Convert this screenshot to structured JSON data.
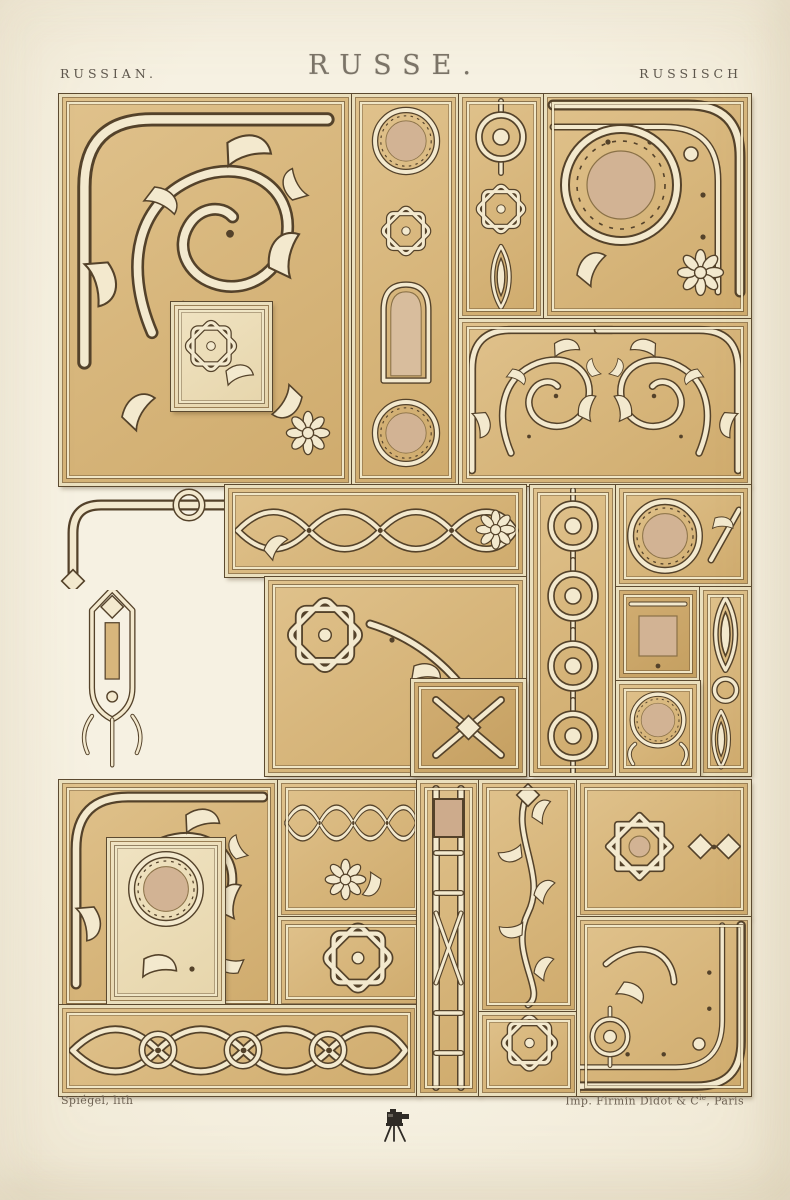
{
  "header": {
    "left_title": "RUSSIAN.",
    "center_title": "RUSSE.",
    "right_title": "RUSSISCH"
  },
  "footer": {
    "lithographer": "Spiégel, lith",
    "printer_prefix": "Imp. Firmin Didot & C",
    "printer_sup": "ie",
    "printer_suffix": ", Paris"
  },
  "icons": {
    "collection_mark": "camera-on-tripod-icon"
  },
  "palette": {
    "paper": "#f5f0e1",
    "panel_tan": "#d8b77e",
    "panel_tan_dark": "#c8a465",
    "panel_light": "#eee2c0",
    "ornament_cream": "#f3e9ce",
    "outline_brown": "#54422a",
    "medallion_rose": "#d2b394",
    "title_ink": "#5d564c"
  }
}
